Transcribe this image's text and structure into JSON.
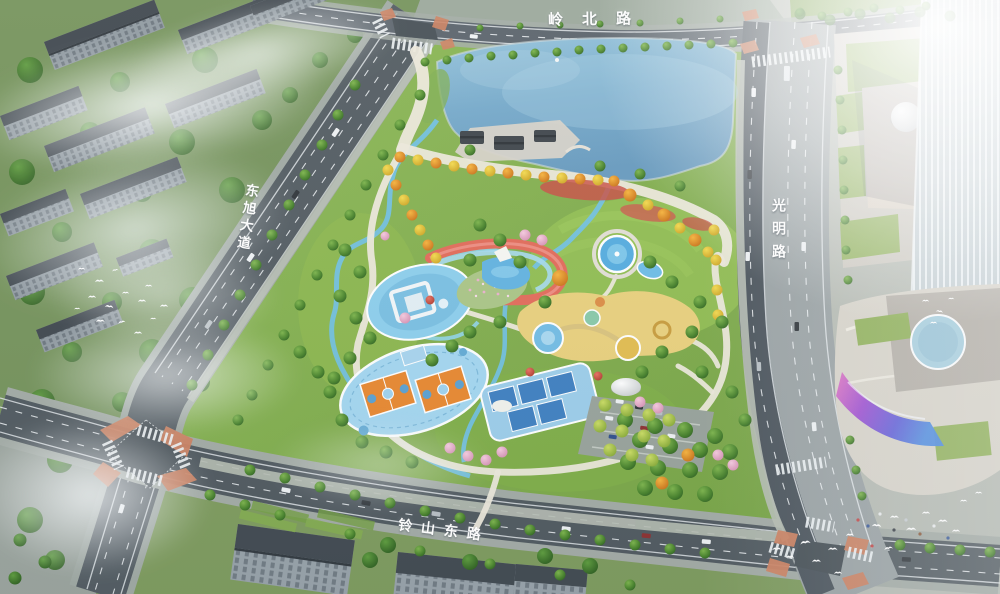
{
  "labels": {
    "road_top": "岭北路",
    "road_left": "东旭大道",
    "road_right": "光明路",
    "road_bottom": "铃山东路"
  },
  "palette": {
    "lake_blue": "#6fa3c6",
    "park_green": "#85b14c",
    "road_dark": "#4f585e",
    "road_light": "#99a1a3",
    "crosswalk_corner_orange": "#cd8160",
    "basketball_court_orange": "#e8872e",
    "court_surround_blue": "#a3d6f0",
    "ribbon_path_red": "#e26a58",
    "playground_yellow": "#e9d07c",
    "led_screen_purple": "#9a46d0",
    "autumn_tree_orange": "#e09a2e",
    "building_gray": "#909aa1",
    "mist_white": "#ffffff"
  },
  "features": {
    "list": [
      "lake",
      "lakeside-pavilions",
      "autumn-tree-promenade",
      "circular-blue-plaza",
      "red-ribbon-path",
      "flower-meadow",
      "central-pond",
      "fountain-pool",
      "children-playground",
      "basketball-courts",
      "tennis-courts",
      "dome-structure",
      "tree-shaded-parking",
      "residential-blocks",
      "commercial-podium",
      "glass-tower",
      "mall-led-screen",
      "rooftop-blue-pad",
      "bird-flocks",
      "road-intersections",
      "mist-and-sun-glare"
    ]
  }
}
